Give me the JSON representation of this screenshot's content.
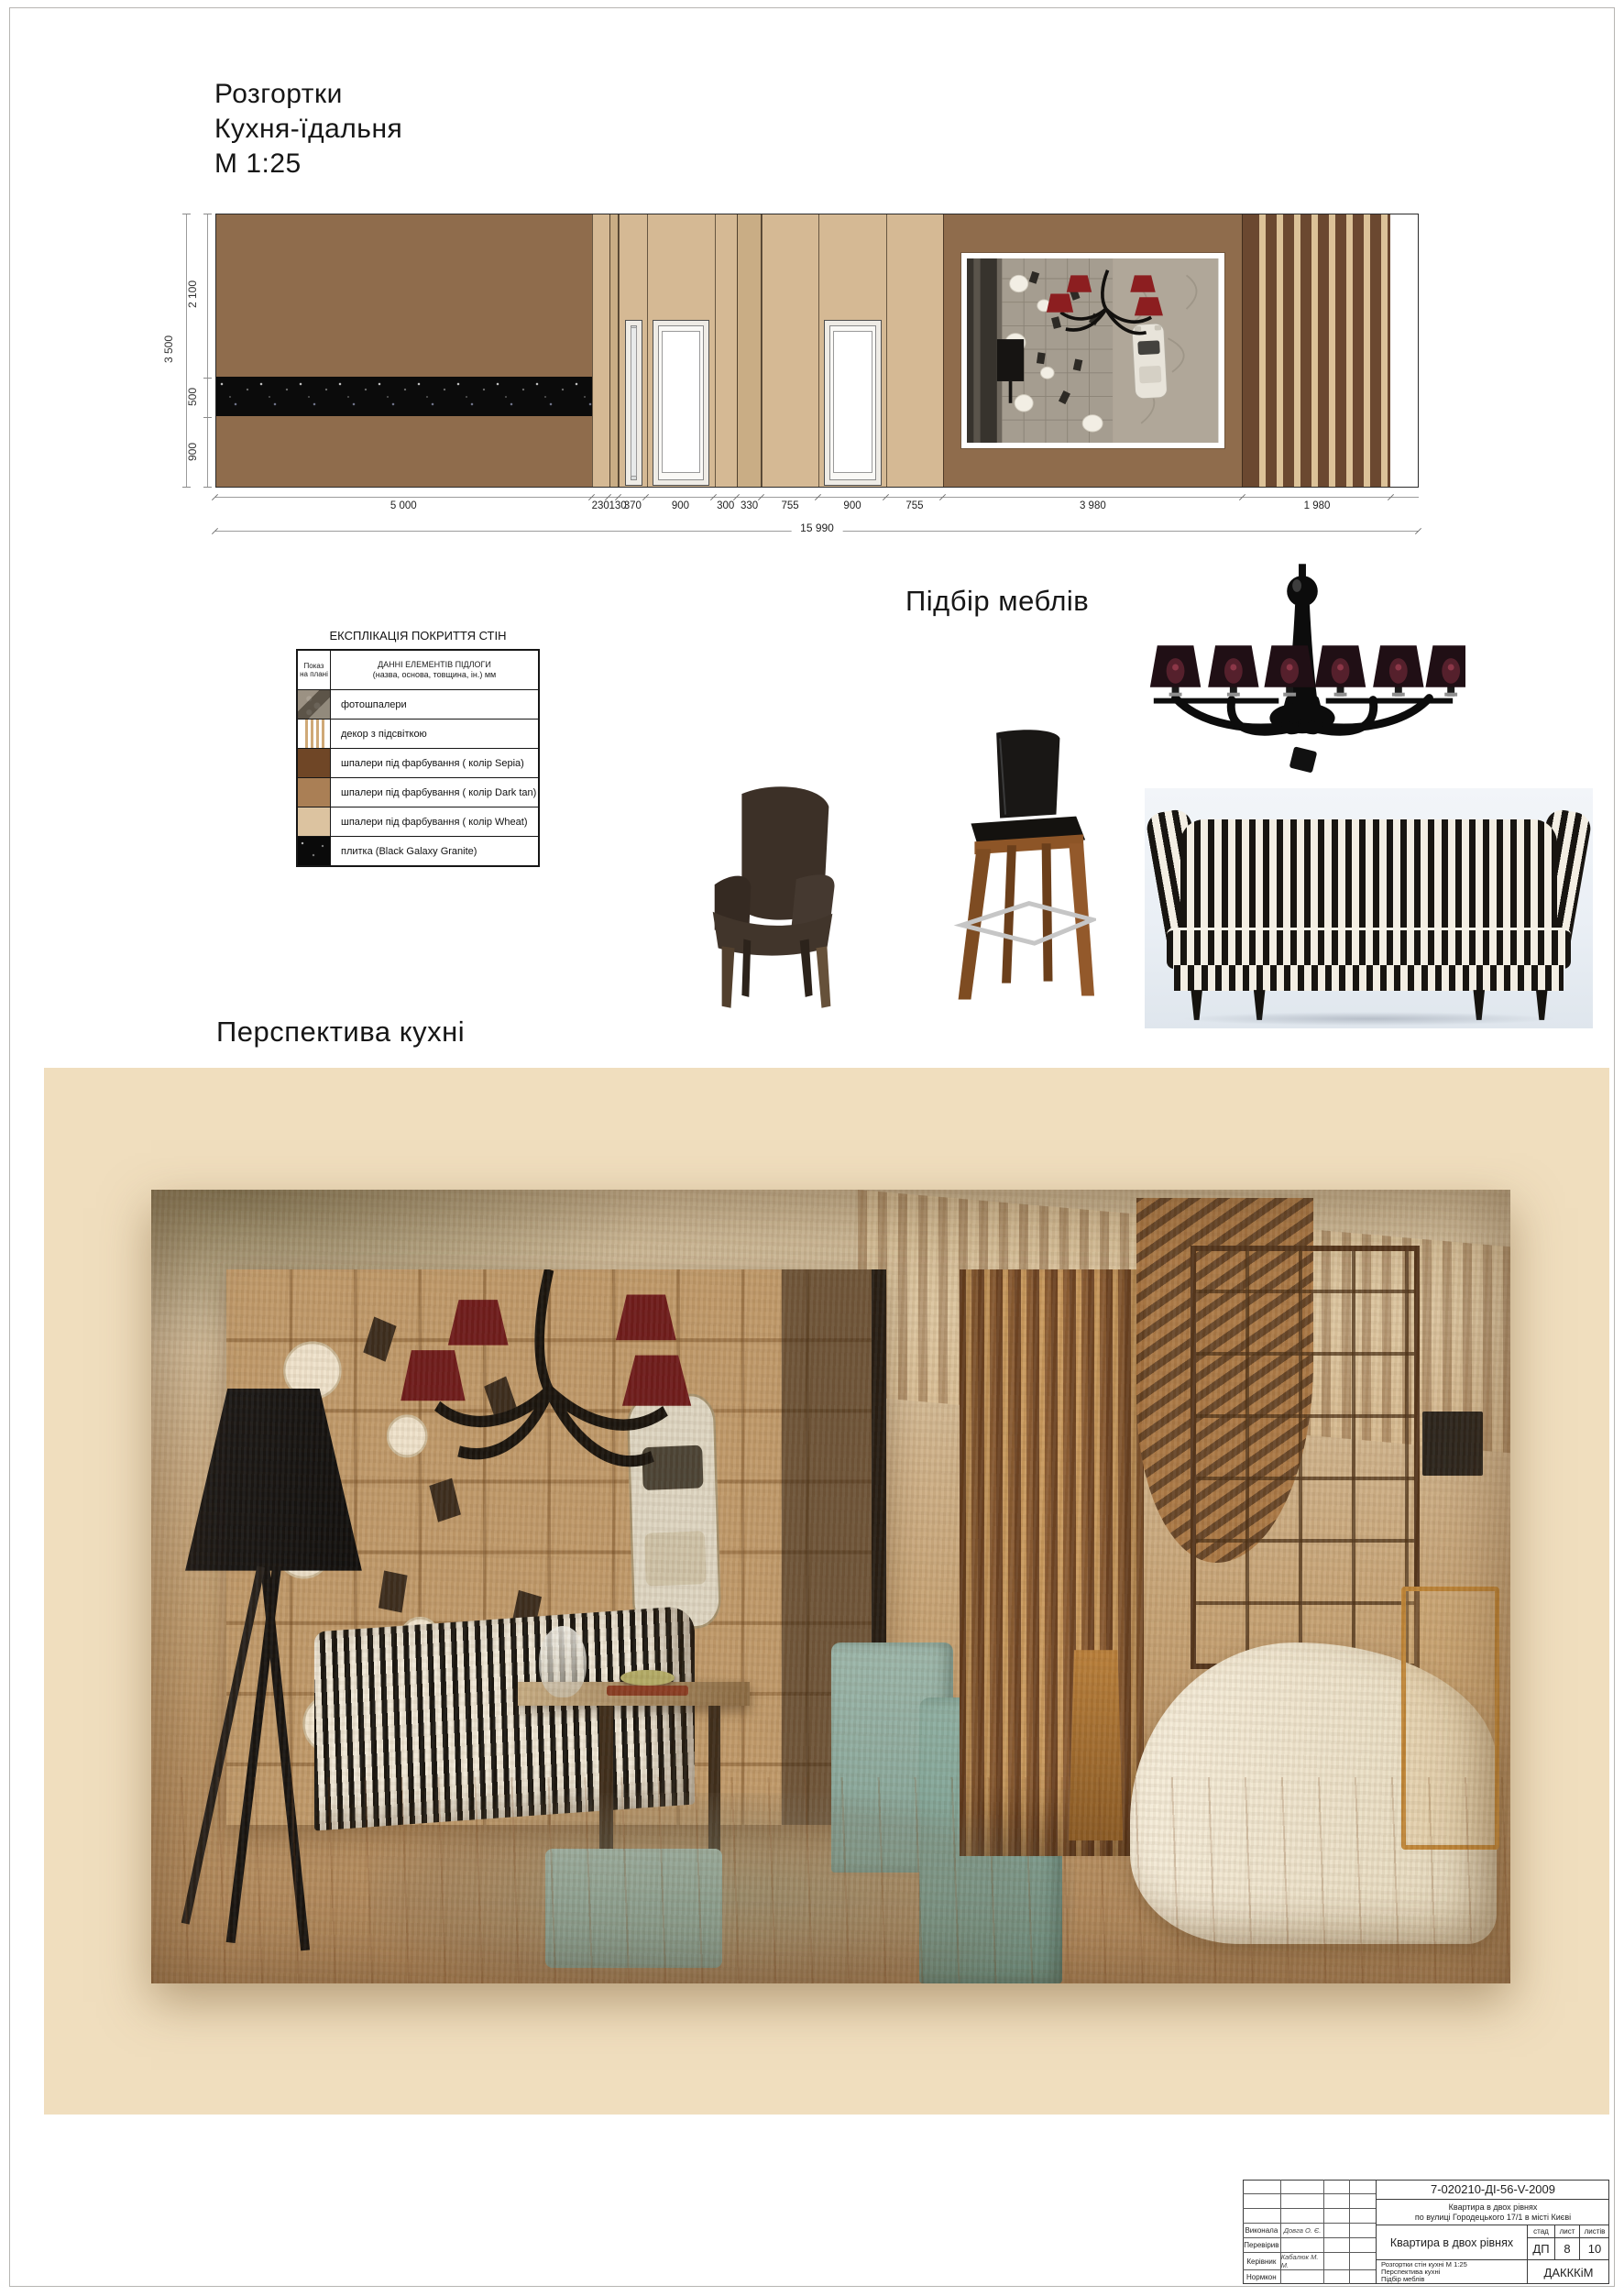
{
  "header": {
    "line1": "Розгортки",
    "line2": "Кухня-їдальня",
    "line3": "М 1:25"
  },
  "sections": {
    "furniture_title": "Підбір меблів",
    "perspective_title": "Перспектива кухні"
  },
  "elevation": {
    "total_width_mm": 15990,
    "total_width_label": "15 990",
    "total_height_label": "3 500",
    "left_dims": [
      {
        "label": "2 100"
      },
      {
        "label": "500"
      },
      {
        "label": "900"
      }
    ],
    "segments": [
      {
        "label": "5 000",
        "mm": 5000,
        "finish": "dark_tan",
        "feature": "granite_band"
      },
      {
        "label": "230",
        "mm": 230,
        "finish": "wheat"
      },
      {
        "label": "130",
        "mm": 130,
        "finish": "wheat_strip"
      },
      {
        "label": "370",
        "mm": 370,
        "finish": "wheat",
        "feature": "door_narrow"
      },
      {
        "label": "900",
        "mm": 900,
        "finish": "wheat",
        "feature": "door"
      },
      {
        "label": "300",
        "mm": 300,
        "finish": "wheat"
      },
      {
        "label": "330",
        "mm": 330,
        "finish": "wheat_strip"
      },
      {
        "label": "755",
        "mm": 755,
        "finish": "wheat"
      },
      {
        "label": "900",
        "mm": 900,
        "finish": "wheat",
        "feature": "door"
      },
      {
        "label": "755",
        "mm": 755,
        "finish": "wheat"
      },
      {
        "label": "3 980",
        "mm": 3980,
        "finish": "dark_tan",
        "feature": "photo_mural"
      },
      {
        "label": "1 980",
        "mm": 1980,
        "finish": "backlit_decor"
      }
    ],
    "colors": {
      "sepia": "#6b4830",
      "dark_tan": "#8f6c4c",
      "wheat": "#d5b994",
      "stripe_light": "#dcc298",
      "granite": "#0b0b0b"
    }
  },
  "legend": {
    "title": "ЕКСПЛІКАЦІЯ ПОКРИТТЯ СТІН",
    "header_col1": "Показ на плані",
    "header_col2_line1": "ДАННІ ЕЛЕМЕНТІВ ПІДЛОГИ",
    "header_col2_line2": "(назва, основа, товщина, ін.) мм",
    "rows": [
      {
        "swatch": "photo",
        "label": "фотошпалери"
      },
      {
        "swatch": "backlit",
        "label": "декор з підсвіткою"
      },
      {
        "swatch": "plain",
        "color": "#6f4626",
        "label": "шпалери під фарбування ( колір Sepia)"
      },
      {
        "swatch": "plain",
        "color": "#aa7f55",
        "label": "шпалери під фарбування ( колір Dark tan)"
      },
      {
        "swatch": "plain",
        "color": "#dcc3a0",
        "label": "шпалери під фарбування ( колір Wheat)"
      },
      {
        "swatch": "granite",
        "label": "плитка (Black Galaxy Granite)"
      }
    ]
  },
  "furniture_items": [
    {
      "name": "black-chandelier"
    },
    {
      "name": "dark-brown-armchair"
    },
    {
      "name": "bar-stool"
    },
    {
      "name": "striped-sofa"
    }
  ],
  "titleblock": {
    "doc_number": "7-020210-ДІ-56-V-2009",
    "object_line1": "Квартира в двох рівнях",
    "object_line2": "по вулиці Городецького 17/1 в місті Києві",
    "project_title": "Квартира в двох рівнях",
    "stage_label": "стад",
    "sheet_label": "лист",
    "sheets_label": "листів",
    "stage": "ДП",
    "sheet": "8",
    "sheets": "10",
    "content_line1": "Розгортки стін кухні М 1:25",
    "content_line2": "Перспектива кухні",
    "content_line3": "Підбір меблів",
    "organization": "ДАКККіМ",
    "blank_rows": 3,
    "roles": [
      {
        "role": "Виконала",
        "name": "Довга О. Є."
      },
      {
        "role": "Перевірив",
        "name": ""
      },
      {
        "role": "Керівник",
        "name": "Кабалюк М. М."
      },
      {
        "role": "Нормкон",
        "name": ""
      }
    ]
  }
}
